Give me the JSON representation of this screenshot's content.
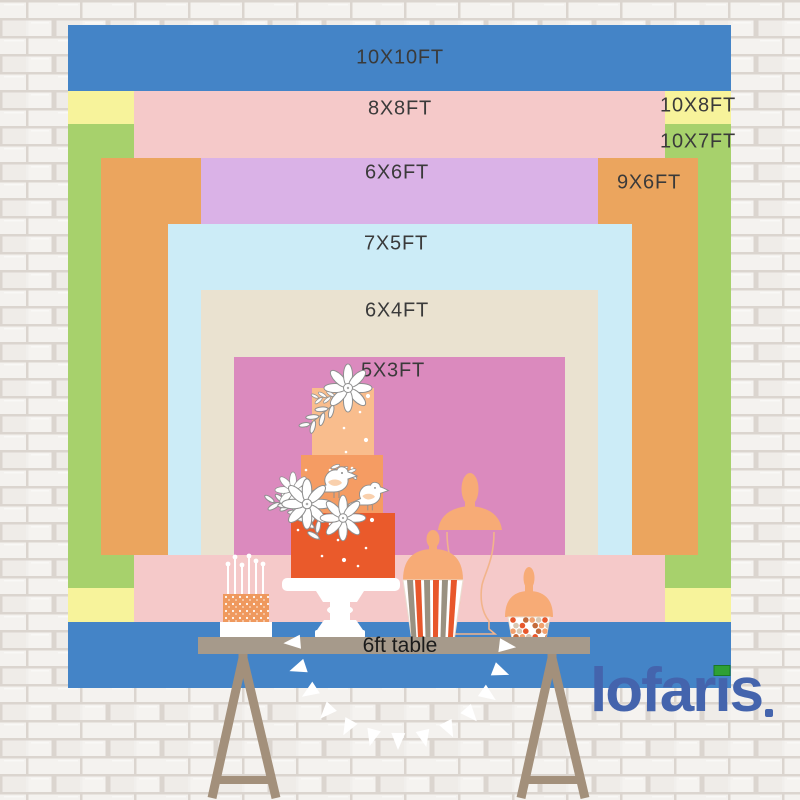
{
  "chart_data": {
    "type": "nested-rectangles",
    "description": "Backdrop size comparison chart, rectangles labeled in feet",
    "unit": "FT",
    "px_per_ft": 66.3,
    "origin": {
      "left": 68,
      "top": 25,
      "center_x": 399.5
    },
    "sizes": [
      {
        "label": "10X10FT",
        "width_ft": 10,
        "height_ft": 10,
        "top_offset_ft": 0,
        "color": "#4484c7",
        "label_cx": 400,
        "label_cy": 58
      },
      {
        "label": "10X8FT",
        "width_ft": 10,
        "height_ft": 8,
        "top_offset_ft": 1,
        "color": "#f7f39b",
        "label_cx": 698,
        "label_cy": 106
      },
      {
        "label": "10X7FT",
        "width_ft": 10,
        "height_ft": 7,
        "top_offset_ft": 1.5,
        "color": "#a7d16c",
        "label_cx": 698,
        "label_cy": 142
      },
      {
        "label": "8X8FT",
        "width_ft": 8,
        "height_ft": 8,
        "top_offset_ft": 1,
        "color": "#f5c9c9",
        "label_cx": 400,
        "label_cy": 109
      },
      {
        "label": "9X6FT",
        "width_ft": 9,
        "height_ft": 6,
        "top_offset_ft": 2,
        "color": "#eba55e",
        "label_cx": 649,
        "label_cy": 183
      },
      {
        "label": "6X6FT",
        "width_ft": 6,
        "height_ft": 6,
        "top_offset_ft": 2,
        "color": "#dab2e7",
        "label_cx": 397,
        "label_cy": 173
      },
      {
        "label": "7X5FT",
        "width_ft": 7,
        "height_ft": 5,
        "top_offset_ft": 3,
        "color": "#ccecf7",
        "label_cx": 396,
        "label_cy": 244
      },
      {
        "label": "6X4FT",
        "width_ft": 6,
        "height_ft": 4,
        "top_offset_ft": 4,
        "color": "#eae2d0",
        "label_cx": 397,
        "label_cy": 311
      },
      {
        "label": "5X3FT",
        "width_ft": 5,
        "height_ft": 3,
        "top_offset_ft": 5,
        "color": "#db8abe",
        "label_cx": 393,
        "label_cy": 371
      }
    ]
  },
  "table": {
    "label": "6ft table"
  },
  "logo": {
    "text": "lofaris",
    "parts": {
      "pre": "lofar",
      "dotless_i": "ı",
      "post": "s"
    }
  },
  "icons": {
    "tiered-cake": "three tier orange cake with flowers and birds",
    "candle-cake": "small cake with candles",
    "striped-candy-cup": "striped popcorn candy cup with dome lid",
    "candy-jar": "small candy jar with dome lid",
    "glass-jar-outline": "tall apothecary glass jar outline",
    "bunting-garland": "white triangle flag garland"
  },
  "colors": {
    "label_text": "#3a3a3a",
    "table_top": "#a69a8b",
    "table_leg": "#a3907b",
    "table_label_text": "#1b1b1b",
    "logo_blue": "#4464ad",
    "logo_green": "#2ea035",
    "logo_green_border": "#1a7a24",
    "peach": "#f7ab76",
    "jar_line": "#f2b48b",
    "tier1": "#f9bd8d",
    "tier2": "#f59c63",
    "tier3": "#ea5a2b",
    "speckle_base": "#ef995e",
    "stripe_orange": "#e8572b",
    "stripe_grey": "#9a9181",
    "outline_grey": "#8f8f8f",
    "wing": "#f8cba4",
    "brick_fill": "#f1efec",
    "brick_mortar": "#dbd5cf",
    "flag_white": "#ffffff",
    "candy_palette": [
      "#e8572b",
      "#f2a16e",
      "#ffffff",
      "#d8c7b2",
      "#c46a3a"
    ]
  }
}
